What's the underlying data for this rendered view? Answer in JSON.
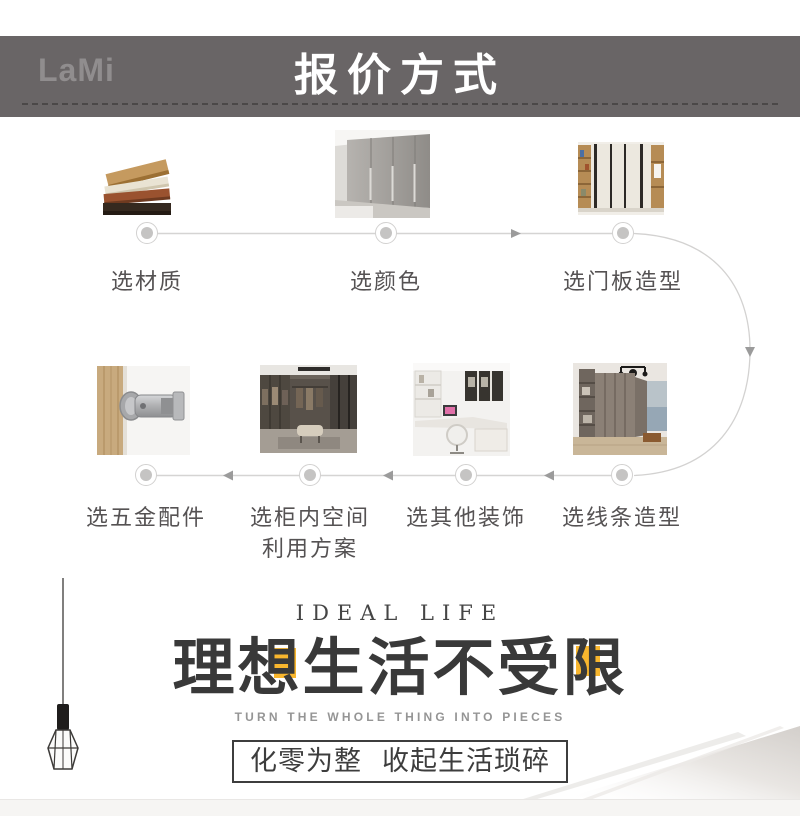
{
  "header": {
    "logo": "LaMi",
    "title": "报价方式"
  },
  "flow": {
    "row1": [
      {
        "label": "选材质",
        "image": "material-stack"
      },
      {
        "label": "选颜色",
        "image": "gray-wardrobe"
      },
      {
        "label": "选门板造型",
        "image": "door-panel-wardrobe"
      }
    ],
    "row2": [
      {
        "label": "选五金配件",
        "image": "hinge-hardware"
      },
      {
        "label_line1": "选柜内空间",
        "label_line2": "利用方案",
        "image": "walk-in-closet"
      },
      {
        "label": "选其他装饰",
        "image": "corner-desk"
      },
      {
        "label": "选线条造型",
        "image": "trim-wardrobe"
      }
    ]
  },
  "hero": {
    "eyebrow": "IDEAL LIFE",
    "title": "理想生活不受限",
    "subtitle": "TURN THE WHOLE THING INTO PIECES",
    "box_left": "化零为整",
    "box_right": "收起生活琐碎"
  },
  "colors": {
    "header_bar": "#696566",
    "header_dash": "#4b4848",
    "accent_yellow": "#f8b62e",
    "flow_line": "#d5d4d3",
    "arrow": "#9b9b9b",
    "dot_core": "#c5c4c3",
    "label_text": "#555253",
    "title_text": "#393939"
  }
}
